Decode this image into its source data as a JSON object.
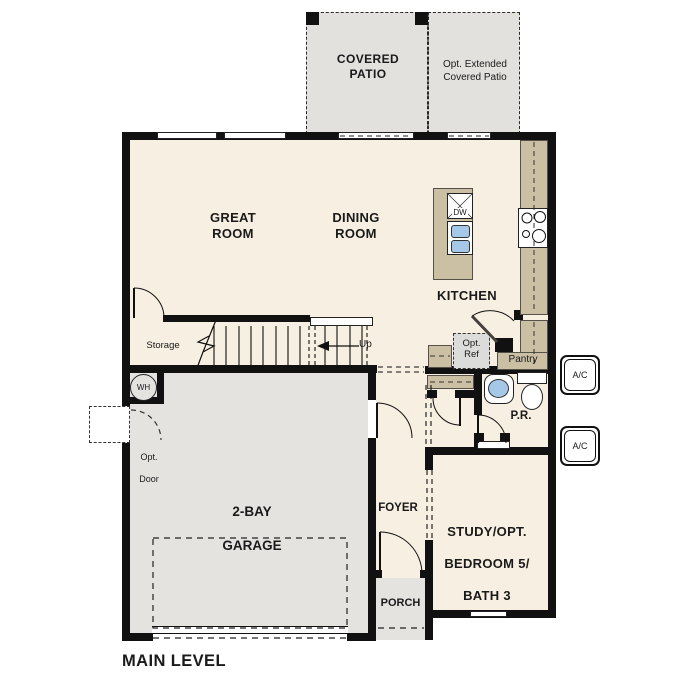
{
  "title": "MAIN LEVEL",
  "colors": {
    "floor": "#f7efe1",
    "garage_and_porch": "#e4e3e0",
    "patio": "#e2e1de",
    "counter_tan": "#cbbfa4",
    "fixture_blue": "#a6c8e8",
    "wall": "#111111",
    "optional_gray": "#dcdcda"
  },
  "rooms": {
    "covered_patio": "COVERED PATIO",
    "opt_extended_patio": "Opt. Extended Covered Patio",
    "great_room": "GREAT ROOM",
    "dining_room": "DINING ROOM",
    "kitchen": "KITCHEN",
    "storage": "Storage",
    "pantry": "Pantry",
    "powder_room": "P.R.",
    "foyer": "FOYER",
    "study": [
      "STUDY/OPT.",
      "BEDROOM 5/",
      "BATH 3"
    ],
    "garage": [
      "2-BAY",
      "GARAGE"
    ],
    "porch": "PORCH"
  },
  "labels": {
    "up": "Up",
    "water_heater": "WH",
    "dishwasher": "DW",
    "opt_ref": [
      "Opt.",
      "Ref"
    ],
    "opt_door": [
      "Opt.",
      "Door"
    ],
    "ac_unit": "A/C",
    "main_level": "MAIN LEVEL"
  }
}
